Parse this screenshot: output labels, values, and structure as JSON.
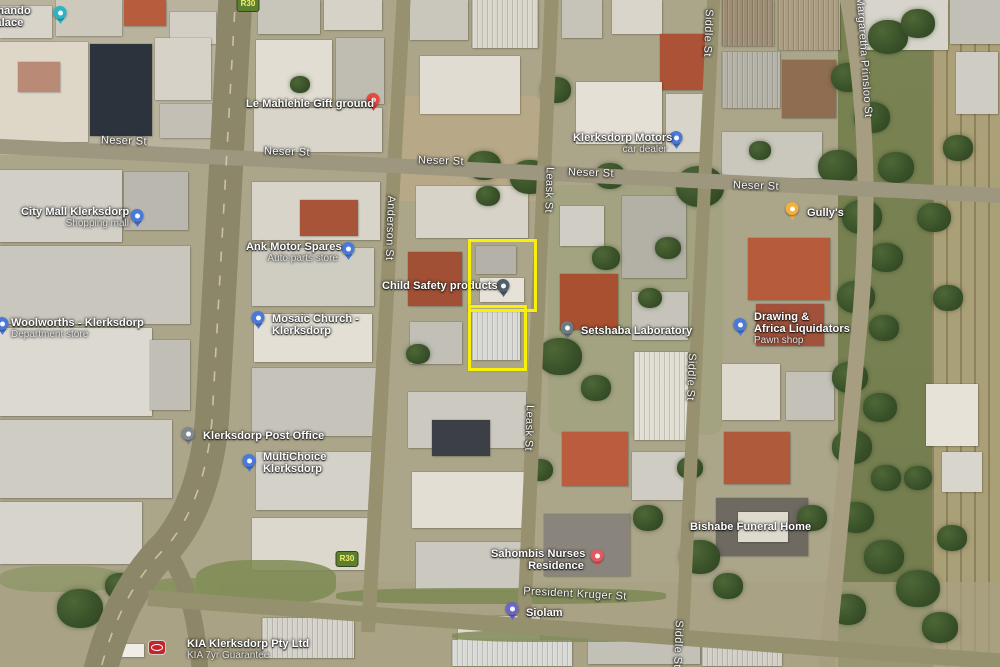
{
  "map": {
    "kind": "satellite-map-with-annotation",
    "highlight": {
      "color": "#f8ef0b",
      "rects": [
        {
          "id": "highlight-rect-upper",
          "x": 468,
          "y": 239,
          "w": 63,
          "h": 67
        },
        {
          "id": "highlight-rect-lower",
          "x": 468,
          "y": 305,
          "w": 53,
          "h": 60
        }
      ]
    },
    "route_shields": [
      {
        "text": "R30",
        "x": 248,
        "y": 4
      },
      {
        "text": "R30",
        "x": 347,
        "y": 559
      }
    ],
    "street_labels": [
      {
        "text": "Neser St",
        "x": 124,
        "y": 141,
        "rot": 2
      },
      {
        "text": "Neser St",
        "x": 287,
        "y": 152,
        "rot": 2
      },
      {
        "text": "Neser St",
        "x": 441,
        "y": 161,
        "rot": 2
      },
      {
        "text": "Neser St",
        "x": 591,
        "y": 173,
        "rot": 2
      },
      {
        "text": "Neser St",
        "x": 756,
        "y": 186,
        "rot": 2
      },
      {
        "text": "Anderson St",
        "x": 390,
        "y": 228,
        "rot": 92
      },
      {
        "text": "Leask St",
        "x": 549,
        "y": 190,
        "rot": 92
      },
      {
        "text": "Leask St",
        "x": 529,
        "y": 428,
        "rot": 92
      },
      {
        "text": "Siddle St",
        "x": 708,
        "y": 33,
        "rot": 92
      },
      {
        "text": "Siddle St",
        "x": 691,
        "y": 377,
        "rot": 92
      },
      {
        "text": "Siddle St",
        "x": 678,
        "y": 644,
        "rot": 92
      },
      {
        "text": "Margaretha Prinsloo St",
        "x": 864,
        "y": 57,
        "rot": 86
      },
      {
        "text": "President Kruger St",
        "x": 575,
        "y": 594,
        "rot": 3
      }
    ],
    "pois": [
      {
        "id": "palace",
        "name": "amando",
        "name2": "Palace",
        "pin": {
          "x": 60,
          "y": 15,
          "color": "#2ab5c6"
        },
        "label": {
          "x": -12,
          "y": 5,
          "align": "left"
        }
      },
      {
        "id": "gift-ground",
        "name": "Le Mahlehle Gift ground",
        "pin": {
          "x": 373,
          "y": 102,
          "color": "#e9483f"
        },
        "label": {
          "x": 246,
          "y": 98,
          "align": "left"
        }
      },
      {
        "id": "klerksdorp-motors",
        "name": "Klerksdorp Motors",
        "sub": "car dealer",
        "pin": {
          "x": 676,
          "y": 140,
          "color": "#4a79d9"
        },
        "label": {
          "x": 573,
          "y": 132,
          "w": 94,
          "align": "right"
        }
      },
      {
        "id": "gullys",
        "name": "Gully's",
        "pin": {
          "x": 792,
          "y": 211,
          "color": "#f4b03f"
        },
        "label": {
          "x": 807,
          "y": 207,
          "align": "left"
        }
      },
      {
        "id": "city-mall",
        "name": "City Mall Klerksdorp",
        "sub": "Shopping mall",
        "pin": {
          "x": 137,
          "y": 218,
          "color": "#4a79d9"
        },
        "label": {
          "x": 21,
          "y": 206,
          "w": 108,
          "align": "right"
        }
      },
      {
        "id": "ank-motor-spares",
        "name": "Ank Motor Spares",
        "sub": "Auto parts store",
        "pin": {
          "x": 348,
          "y": 251,
          "color": "#4a79d9"
        },
        "label": {
          "x": 246,
          "y": 241,
          "w": 92,
          "align": "right"
        }
      },
      {
        "id": "woolworths",
        "name": "Woolworths - Klerksdorp",
        "sub": "Department store",
        "pin": {
          "x": 2,
          "y": 326,
          "color": "#4a79d9"
        },
        "label": {
          "x": 11,
          "y": 317,
          "align": "left"
        }
      },
      {
        "id": "church",
        "name": "Mosaic Church -",
        "name2": "Klerksdorp",
        "pin": {
          "x": 258,
          "y": 320,
          "color": "#4a79d9"
        },
        "label": {
          "x": 272,
          "y": 313,
          "align": "left"
        }
      },
      {
        "id": "child-safety",
        "name": "Child Safety products",
        "pin": {
          "x": 503,
          "y": 288,
          "color": "#50606a"
        },
        "label": {
          "x": 382,
          "y": 280,
          "align": "left"
        }
      },
      {
        "id": "laboratory",
        "name": "Setshaba Laboratory",
        "pin": {
          "x": 567,
          "y": 330,
          "color": "#6d7a80"
        },
        "label": {
          "x": 581,
          "y": 325,
          "align": "left"
        }
      },
      {
        "id": "drawing-africa-liquidators",
        "name": "Drawing &",
        "name2": "Africa Liquidators",
        "sub": "Pawn shop",
        "pin": {
          "x": 740,
          "y": 327,
          "color": "#4a79d9"
        },
        "label": {
          "x": 754,
          "y": 311,
          "align": "left"
        }
      },
      {
        "id": "post-office",
        "name": "Klerksdorp Post Office",
        "pin": {
          "x": 188,
          "y": 436,
          "color": "#82898e"
        },
        "label": {
          "x": 203,
          "y": 430,
          "align": "left"
        }
      },
      {
        "id": "multichoice",
        "name": "MultiChoice",
        "name2": "Klerksdorp",
        "pin": {
          "x": 249,
          "y": 463,
          "color": "#4a79d9"
        },
        "label": {
          "x": 263,
          "y": 451,
          "align": "left"
        }
      },
      {
        "id": "bishabe-funeral-home",
        "name": "Bishabe Funeral Home",
        "label": {
          "x": 690,
          "y": 521,
          "align": "left"
        }
      },
      {
        "id": "nurses-residence",
        "name": "Sahombis Nurses",
        "name2": "Residence",
        "pin": {
          "x": 597,
          "y": 558,
          "color": "#e05a64"
        },
        "label": {
          "x": 491,
          "y": 548,
          "w": 93,
          "align": "right"
        }
      },
      {
        "id": "siolam",
        "name": "Siolam",
        "pin": {
          "x": 512,
          "y": 611,
          "color": "#6a67c6"
        },
        "label": {
          "x": 526,
          "y": 607,
          "align": "left"
        }
      },
      {
        "id": "kia-dealer",
        "name": "KIA Klerksdorp Pty Ltd",
        "sub": "KIA 7yr Guarantee",
        "logo": {
          "x": 149,
          "y": 641,
          "color": "#c5232b"
        },
        "label": {
          "x": 187,
          "y": 638,
          "align": "left"
        }
      }
    ]
  }
}
